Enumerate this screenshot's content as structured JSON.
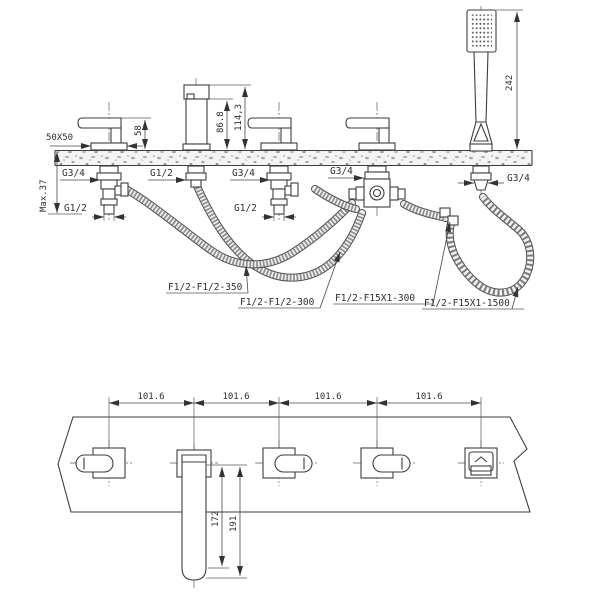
{
  "drawing": {
    "type": "technical installation diagram",
    "subject": "5-hole deck-mounted bathtub mixer with hand shower"
  },
  "top_view": {
    "dimensions": {
      "escutcheon_size": "50X50",
      "handle_height": "58",
      "spout_outlet_height": "86.8",
      "spout_total_height": "114,3",
      "handshower_height": "242",
      "max_deck_thickness": "Max.37"
    },
    "connections": {
      "valve1_shank": "G3/4",
      "valve1_inlet": "G1/2",
      "spout_shank": "G1/2",
      "valve2_shank": "G3/4",
      "valve2_inlet": "G1/2",
      "diverter_shank": "G3/4",
      "handshower_shank": "G3/4"
    },
    "hose_labels": [
      "F1/2-F1/2-350",
      "F1/2-F1/2-300",
      "F1/2-F15X1-300",
      "F1/2-F15X1-1500"
    ]
  },
  "bottom_view": {
    "hole_spacings": [
      "101.6",
      "101.6",
      "101.6",
      "101.6"
    ],
    "spout_reach_inner": "172",
    "spout_reach_outer": "191"
  },
  "colors": {
    "line": "#3d3d3d",
    "background": "#ffffff",
    "deck_speckle": "#9a9a9a"
  }
}
